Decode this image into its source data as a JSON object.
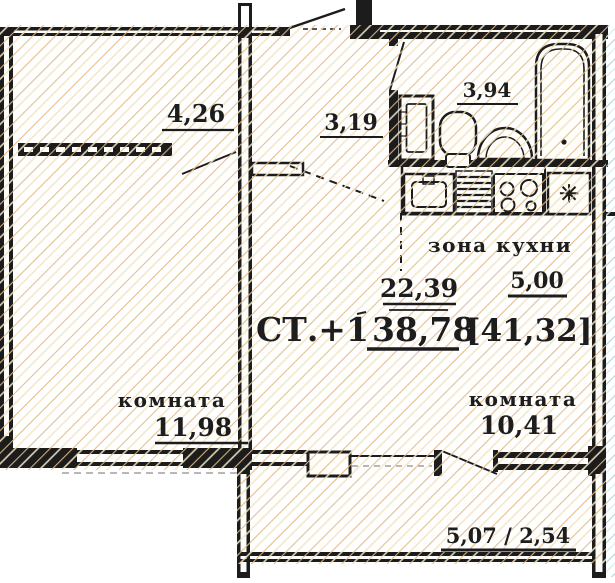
{
  "colors": {
    "wall": "#1c1c1c",
    "text": "#1d1d1d",
    "hatch_primary": "#e2b983",
    "hatch_light": "#f4e5c4",
    "neighbor_primary": "#a5ced6",
    "neighbor_light": "#d8edef",
    "paper": "#ffffff"
  },
  "plan": {
    "rooms": {
      "hallway": {
        "area": "4,26"
      },
      "corridor": {
        "area": "3,19"
      },
      "bathroom": {
        "area": "3,94"
      },
      "kitchen_zone": {
        "label": "зона кухни",
        "area": "5,00"
      },
      "living_combined": {
        "area": "22,39"
      },
      "room_left": {
        "label": "комната",
        "area": "11,98"
      },
      "room_right": {
        "label": "комната",
        "area": "10,41"
      },
      "balcony": {
        "area": "5,07 / 2,54"
      }
    },
    "summary": {
      "unit_type": "СТ.+1",
      "total_area": "38,78",
      "total_with_balcony": "[41,32]"
    },
    "symbols": {
      "fridge": "✳"
    }
  }
}
